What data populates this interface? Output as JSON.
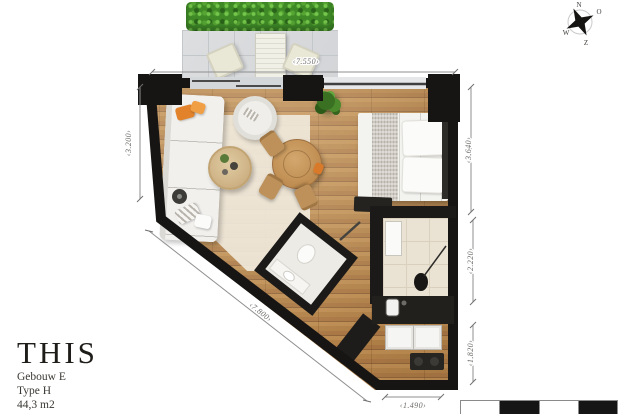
{
  "title_block": {
    "brand": "THIS",
    "building": "Gebouw E",
    "unit_type": "Type H",
    "area": "44,3 m2"
  },
  "dimensions": {
    "top": "‹7.550›",
    "left": "‹3.200›",
    "right_upper": "‹3.640›",
    "right_middle": "‹2.220›",
    "right_lower": "‹1.820›",
    "bottom": "‹1.490›",
    "diagonal": "‹7.800›"
  },
  "compass": {
    "north": "N",
    "east": "O",
    "south": "Z",
    "west": "W"
  },
  "colors": {
    "wall": "#161514",
    "wood_light": "#bd8d53",
    "wood_dark": "#90653a",
    "hedge_green": "#3f8a27",
    "terrace_tile": "#d8dadc",
    "bath_tile": "#eae2d2",
    "dimension_line": "#8f8f8f",
    "title_text": "#1f1d19"
  }
}
